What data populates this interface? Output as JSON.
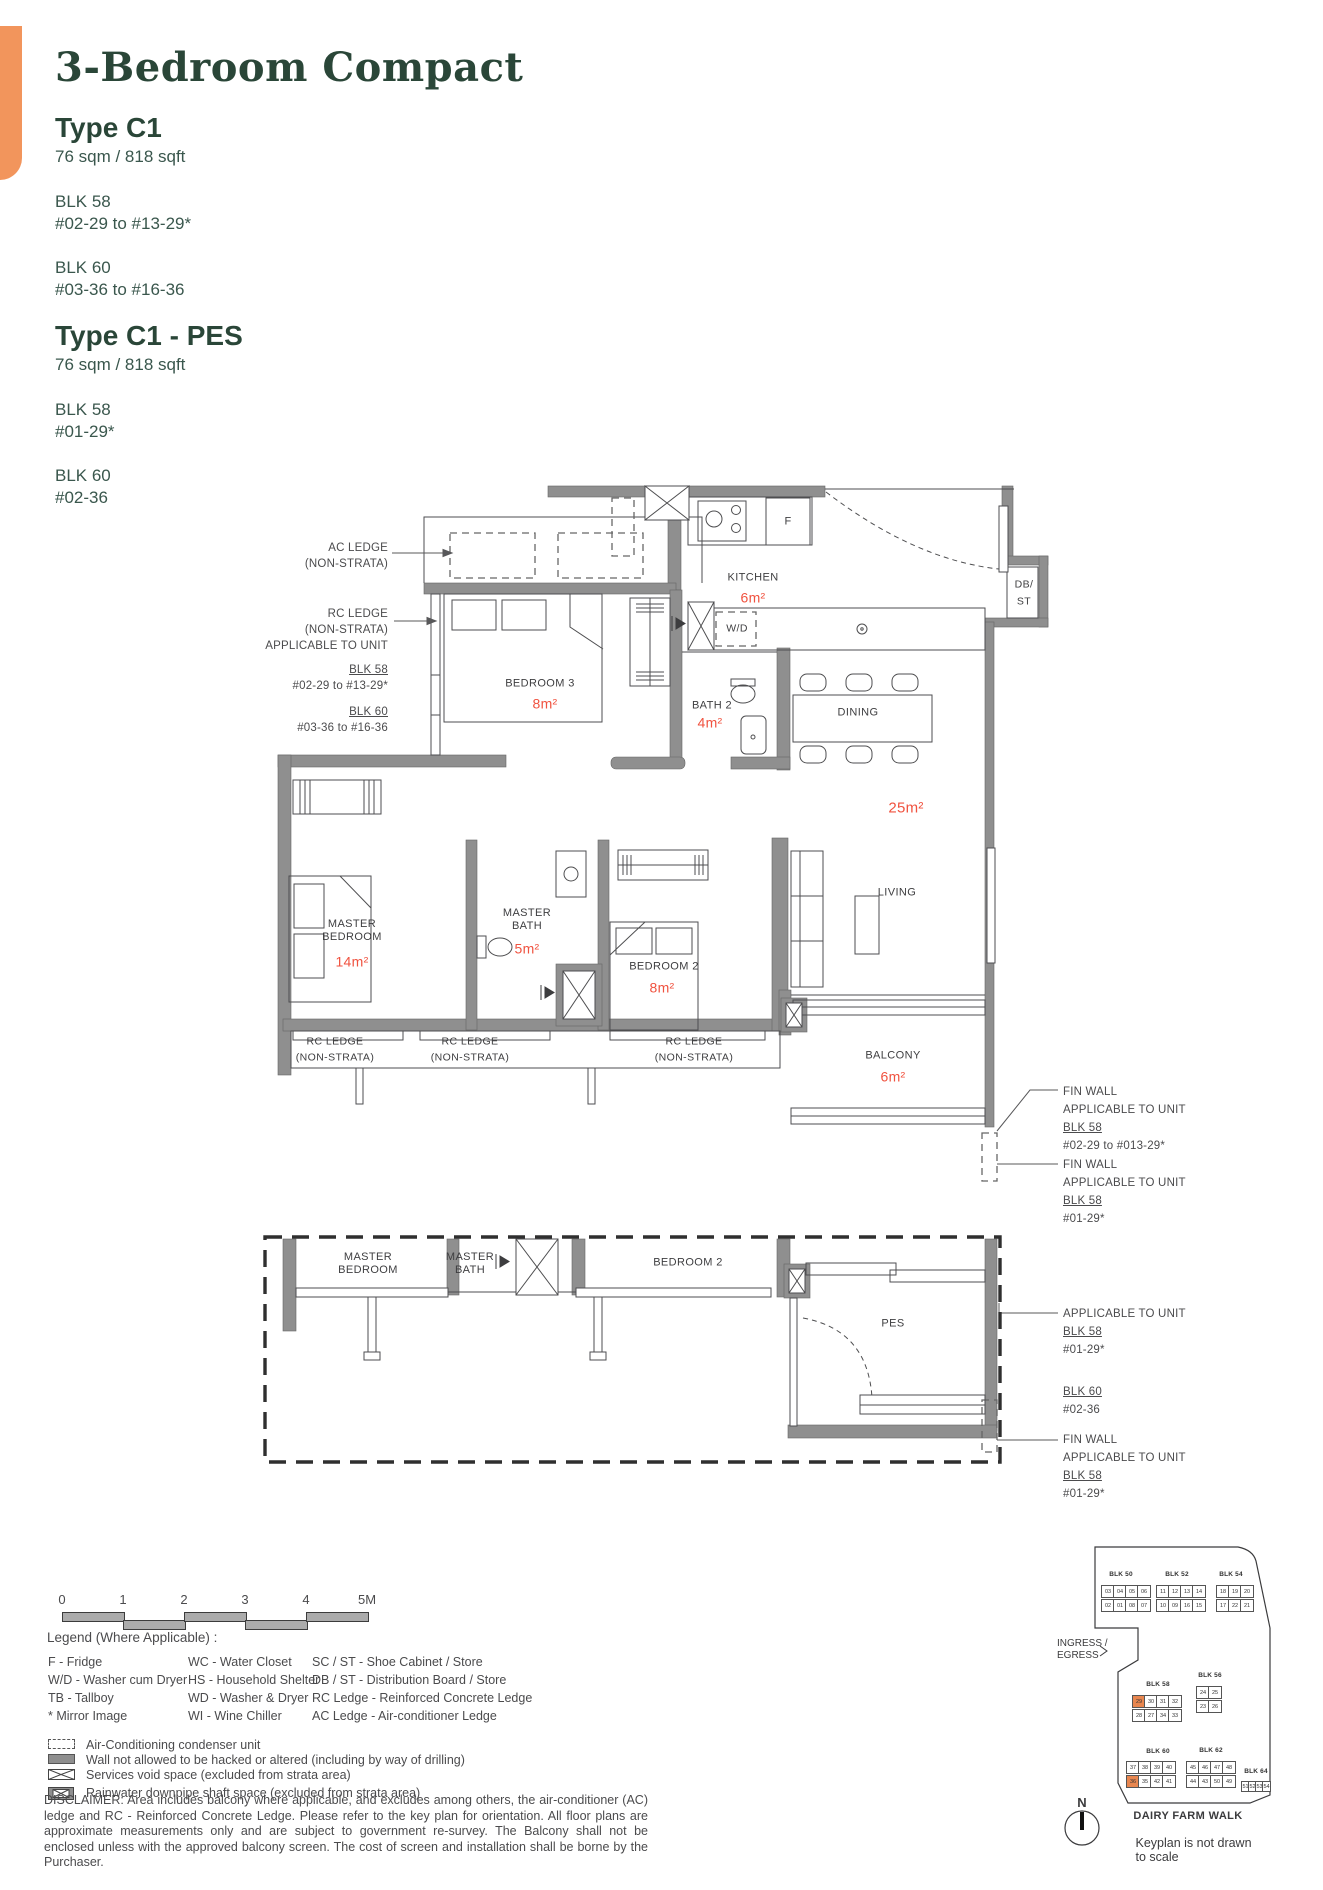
{
  "header": {
    "title": "3-Bedroom Compact",
    "types": [
      {
        "name": "Type C1",
        "area": "76 sqm / 818 sqft",
        "blocks": [
          {
            "blk": "BLK 58",
            "units": "#02-29 to #13-29*"
          },
          {
            "blk": "BLK 60",
            "units": "#03-36 to #16-36"
          }
        ]
      },
      {
        "name": "Type C1 - PES",
        "area": "76 sqm / 818 sqft",
        "blocks": [
          {
            "blk": "BLK 58",
            "units": "#01-29*"
          },
          {
            "blk": "BLK 60",
            "units": "#02-36"
          }
        ]
      }
    ]
  },
  "plan": {
    "rooms": {
      "kitchen": {
        "name": "KITCHEN",
        "area": "6m²"
      },
      "bedroom3": {
        "name": "BEDROOM 3",
        "area": "8m²"
      },
      "bath2": {
        "name": "BATH 2",
        "area": "4m²"
      },
      "dining": {
        "name": "DINING"
      },
      "living": {
        "name": "LIVING",
        "area": "25m²"
      },
      "master_bedroom": {
        "name": "MASTER BEDROOM",
        "area": "14m²"
      },
      "master_bath": {
        "name": "MASTER BATH",
        "area": "5m²"
      },
      "bedroom2": {
        "name": "BEDROOM 2",
        "area": "8m²"
      },
      "balcony": {
        "name": "BALCONY",
        "area": "6m²"
      }
    },
    "fixtures": {
      "wd": "W/D",
      "fridge": "F",
      "db_st_1": "DB/",
      "db_st_2": "ST"
    },
    "rc_ledge": {
      "line1": "RC LEDGE",
      "line2": "(NON-STRATA)"
    },
    "pes": {
      "master_bedroom": "MASTER BEDROOM",
      "master_bath": "MASTER BATH",
      "bedroom2": "BEDROOM 2",
      "pes": "PES"
    }
  },
  "annotations": {
    "ac_ledge": [
      "AC LEDGE",
      "(NON-STRATA)"
    ],
    "rc_ledge_left": {
      "l1": "RC LEDGE",
      "l2": "(NON-STRATA)",
      "l3": "APPLICABLE TO UNIT",
      "blk1": "BLK 58",
      "unit1": "#02-29 to #13-29*",
      "blk2": "BLK 60",
      "unit2": "#03-36 to #16-36"
    },
    "fin_wall_1": {
      "l1": "FIN WALL",
      "l2": "APPLICABLE TO UNIT",
      "blk": "BLK 58",
      "unit": "#02-29 to #013-29*"
    },
    "fin_wall_2": {
      "l1": "FIN WALL",
      "l2": "APPLICABLE TO UNIT",
      "blk": "BLK 58",
      "unit": "#01-29*"
    },
    "pes_applicable": {
      "l1": "APPLICABLE TO UNIT",
      "blk1": "BLK 58",
      "unit1": "#01-29*",
      "blk2": "BLK 60",
      "unit2": "#02-36"
    },
    "fin_wall_3": {
      "l1": "FIN WALL",
      "l2": "APPLICABLE TO UNIT",
      "blk": "BLK 58",
      "unit": "#01-29*"
    }
  },
  "scale_bar": {
    "labels": [
      "0",
      "1",
      "2",
      "3",
      "4",
      "5M"
    ],
    "x": 62,
    "y": 1612,
    "segment_width": 61,
    "segment_height": 8
  },
  "legend": {
    "title": "Legend (Where Applicable) :",
    "columns": [
      [
        "F - Fridge",
        "W/D - Washer cum Dryer",
        "TB - Tallboy",
        "* Mirror Image"
      ],
      [
        "WC - Water Closet",
        "HS - Household Shelter",
        "WD - Washer & Dryer",
        "WI - Wine Chiller"
      ],
      [
        "SC / ST - Shoe Cabinet / Store",
        "DB / ST - Distribution Board / Store",
        "RC Ledge - Reinforced Concrete Ledge",
        "AC Ledge - Air-conditioner Ledge"
      ]
    ],
    "symbols": [
      {
        "icon": "ac-condenser-icon",
        "label": "Air-Conditioning condenser unit"
      },
      {
        "icon": "restricted-wall-icon",
        "label": "Wall not allowed to be hacked or altered (including by way of drilling)"
      },
      {
        "icon": "services-void-icon",
        "label": "Services void space (excluded from strata area)"
      },
      {
        "icon": "rainwater-shaft-icon",
        "label": "Rainwater downpipe shaft space (excluded from strata area)"
      }
    ]
  },
  "disclaimer": "DISCLAIMER: Area includes balcony where applicable, and excludes among others, the air-conditioner (AC) ledge and RC - Reinforced Concrete Ledge. Please refer to the key plan for orientation. All floor plans are approximate measurements only and are subject to government re-survey. The Balcony shall not be enclosed unless with the approved balcony screen. The cost of screen and installation shall be borne by the Purchaser.",
  "keyplan": {
    "ingress_1": "INGRESS /",
    "ingress_2": "EGRESS",
    "road": "DAIRY FARM WALK",
    "compass": "N",
    "note": "Keyplan is not drawn to scale",
    "highlight": {
      "BLK 58": "29",
      "BLK 60": "36"
    },
    "highlight_color": "#E8864F",
    "blocks": [
      {
        "name": "BLK 50",
        "label": [
          1121,
          1571
        ],
        "rows": [
          {
            "x": 1101,
            "y": 1585,
            "units": [
              "03",
              "04",
              "05",
              "06"
            ]
          },
          {
            "x": 1101,
            "y": 1599,
            "units": [
              "02",
              "01",
              "08",
              "07"
            ]
          }
        ]
      },
      {
        "name": "BLK 52",
        "label": [
          1177,
          1571
        ],
        "rows": [
          {
            "x": 1156,
            "y": 1585,
            "units": [
              "11",
              "12",
              "13",
              "14"
            ]
          },
          {
            "x": 1156,
            "y": 1599,
            "units": [
              "10",
              "09",
              "16",
              "15"
            ]
          }
        ]
      },
      {
        "name": "BLK 54",
        "label": [
          1231,
          1571
        ],
        "rows": [
          {
            "x": 1216,
            "y": 1585,
            "units": [
              "18",
              "19",
              "20"
            ]
          },
          {
            "x": 1216,
            "y": 1599,
            "units": [
              "17",
              "22",
              "21"
            ]
          }
        ]
      },
      {
        "name": "BLK 56",
        "label": [
          1210,
          1672
        ],
        "rows": [
          {
            "x": 1196,
            "y": 1686,
            "units": [
              "24",
              "25"
            ]
          },
          {
            "x": 1196,
            "y": 1700,
            "units": [
              "23",
              "26"
            ]
          }
        ]
      },
      {
        "name": "BLK 58",
        "label": [
          1158,
          1681
        ],
        "rows": [
          {
            "x": 1132,
            "y": 1695,
            "units": [
              "29",
              "30",
              "31",
              "32"
            ]
          },
          {
            "x": 1132,
            "y": 1709,
            "units": [
              "28",
              "27",
              "34",
              "33"
            ]
          }
        ]
      },
      {
        "name": "BLK 60",
        "label": [
          1158,
          1748
        ],
        "rows": [
          {
            "x": 1126,
            "y": 1761,
            "units": [
              "37",
              "38",
              "39",
              "40"
            ]
          },
          {
            "x": 1126,
            "y": 1775,
            "units": [
              "36",
              "35",
              "42",
              "41"
            ]
          }
        ]
      },
      {
        "name": "BLK 62",
        "label": [
          1211,
          1747
        ],
        "rows": [
          {
            "x": 1186,
            "y": 1761,
            "units": [
              "45",
              "46",
              "47",
              "48"
            ]
          },
          {
            "x": 1186,
            "y": 1775,
            "units": [
              "44",
              "43",
              "50",
              "49"
            ]
          }
        ]
      },
      {
        "name": "BLK 64",
        "label": [
          1256,
          1768
        ],
        "rows": [
          {
            "x": 1241,
            "y": 1781,
            "cw": 7,
            "ch": 9,
            "units": [
              "51",
              "52",
              "53",
              "54"
            ]
          }
        ]
      }
    ]
  },
  "colors": {
    "accent_orange": "#F2955C",
    "heading_green": "#2A4638",
    "area_red": "#F0523F",
    "wall_gray": "#8F8F8F"
  }
}
